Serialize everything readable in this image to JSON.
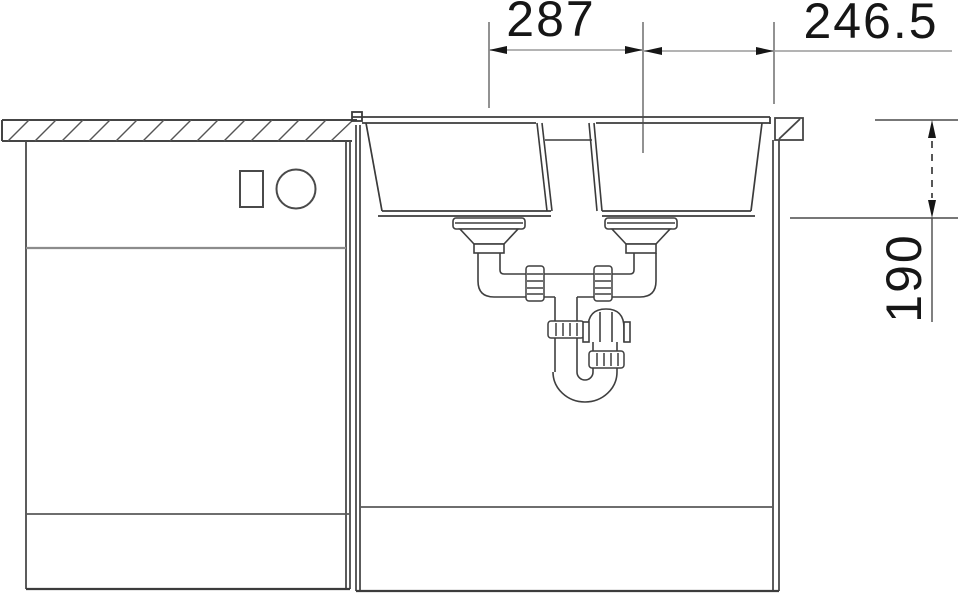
{
  "drawing": {
    "type": "technical-drawing",
    "subject": "double-bowl sink front elevation with base cabinets and siphon drain plumbing",
    "dimensions": {
      "bowl_spacing": "287",
      "right_offset": "246.5",
      "bowl_depth": "190"
    },
    "colors": {
      "line": "#454545",
      "dim_shaft": "#9a9a9a",
      "text": "#161616",
      "background": "#ffffff"
    }
  }
}
